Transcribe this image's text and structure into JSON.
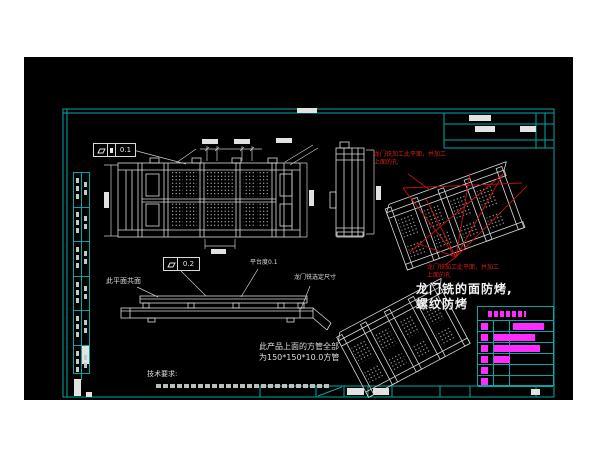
{
  "colors": {
    "page_bg": "#ffffff",
    "canvas_bg": "#000000",
    "sheet_frame": "#00a8a8",
    "drawing_line": "#dcdcdc",
    "annotation_red": "#cf1f1f",
    "highlight_magenta": "#ff2bff"
  },
  "feature_controls": {
    "top_flatness": "0.1",
    "side_flatness": "0.2"
  },
  "notes": {
    "coplanar": "此平面共面",
    "platform_flatness": "平台度0.1",
    "gantry_mill_dimension": "龙门铣选定尺寸",
    "red_machining_line1": "龙门铣加工此平面，并加工",
    "red_machining_line2": "上面的孔",
    "finish_line1": "龙门铣的面防烤,",
    "finish_line2": "螺纹防烤",
    "tube_line1": "此产品上面的方管全部",
    "tube_line2": "为150*150*10.0方管",
    "tech_requirements": "技术要求:"
  },
  "process_table": {
    "row_count": 6,
    "bars": [
      {
        "row": 0,
        "left": 35,
        "width": 31
      },
      {
        "row": 1,
        "left": 16,
        "width": 41
      },
      {
        "row": 2,
        "left": 16,
        "width": 46
      },
      {
        "row": 3,
        "left": 16,
        "width": 16
      }
    ]
  },
  "left_strip": {
    "row_count": 6
  }
}
